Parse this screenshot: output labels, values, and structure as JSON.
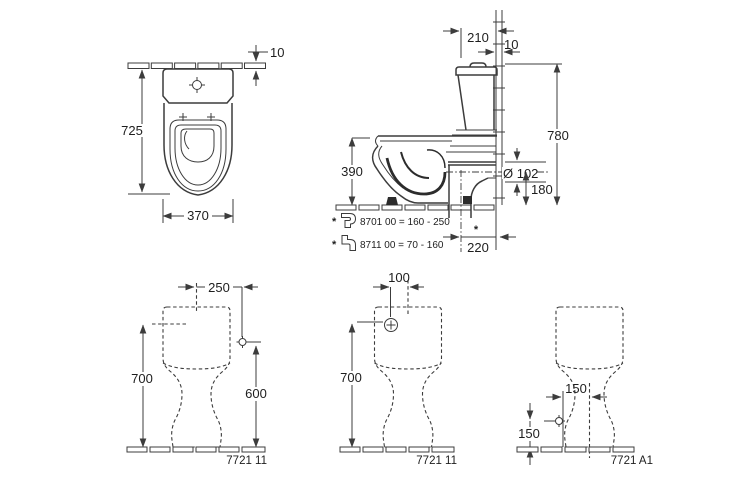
{
  "drawing_type": "toilet-installation-dimension-drawing",
  "colors": {
    "line": "#3c3c3c",
    "text": "#1e1e1e",
    "background": "#ffffff"
  },
  "front_view": {
    "dim_tile_thickness": "10",
    "dim_total_height": "725",
    "dim_width": "370"
  },
  "side_view": {
    "dim_cistern_depth": "210",
    "dim_tile_thickness": "10",
    "dim_total_height": "780",
    "dim_rim_height": "390",
    "dim_outlet_diameter": "Ø 102",
    "dim_outlet_center_height": "180",
    "dim_outlet_wall_distance": "220",
    "asterisk": "*",
    "notes": [
      {
        "marker": "*",
        "code": "8701 00 = 160 - 250"
      },
      {
        "marker": "*",
        "code": "8711 00 = 70 - 160"
      }
    ]
  },
  "rear_view_left": {
    "dim_supply_offset": "250",
    "dim_reference_height": "700",
    "dim_supply_height": "600",
    "label": "7721 11"
  },
  "rear_view_middle": {
    "dim_supply_offset": "100",
    "dim_supply_height": "700",
    "label": "7721 11"
  },
  "rear_view_right": {
    "dim_supply_offset": "150",
    "dim_supply_height": "150",
    "label": "7721 A1"
  }
}
